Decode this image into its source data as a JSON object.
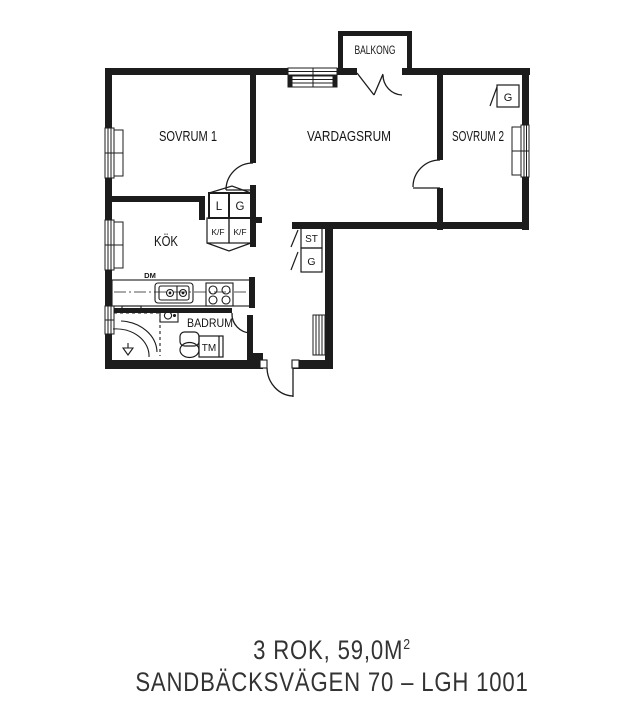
{
  "plan": {
    "balcony_label": "BALKONG",
    "room_labels": {
      "bedroom1": "SOVRUM 1",
      "living_room": "VARDAGSRUM",
      "bedroom2": "SOVRUM 2",
      "kitchen": "KÖK",
      "bathroom": "BADRUM"
    },
    "fixture_labels": {
      "linen_closet": "L",
      "wardrobe_kitchen": "G",
      "fridge_freezer_left": "K/F",
      "fridge_freezer_right": "K/F",
      "cleaning_closet": "ST",
      "wardrobe_hall": "G",
      "wardrobe_bedroom2": "G",
      "washing_machine": "TM",
      "dishwasher": "DM"
    }
  },
  "footer": {
    "area_line": "3 ROK, 59,0M",
    "area_superscript": "2",
    "address_line": "SANDBÄCKSVÄGEN 70 – LGH 1001"
  },
  "colors": {
    "wall": "#1c1c1c",
    "label_text": "#151515",
    "footer_text": "#333333"
  }
}
